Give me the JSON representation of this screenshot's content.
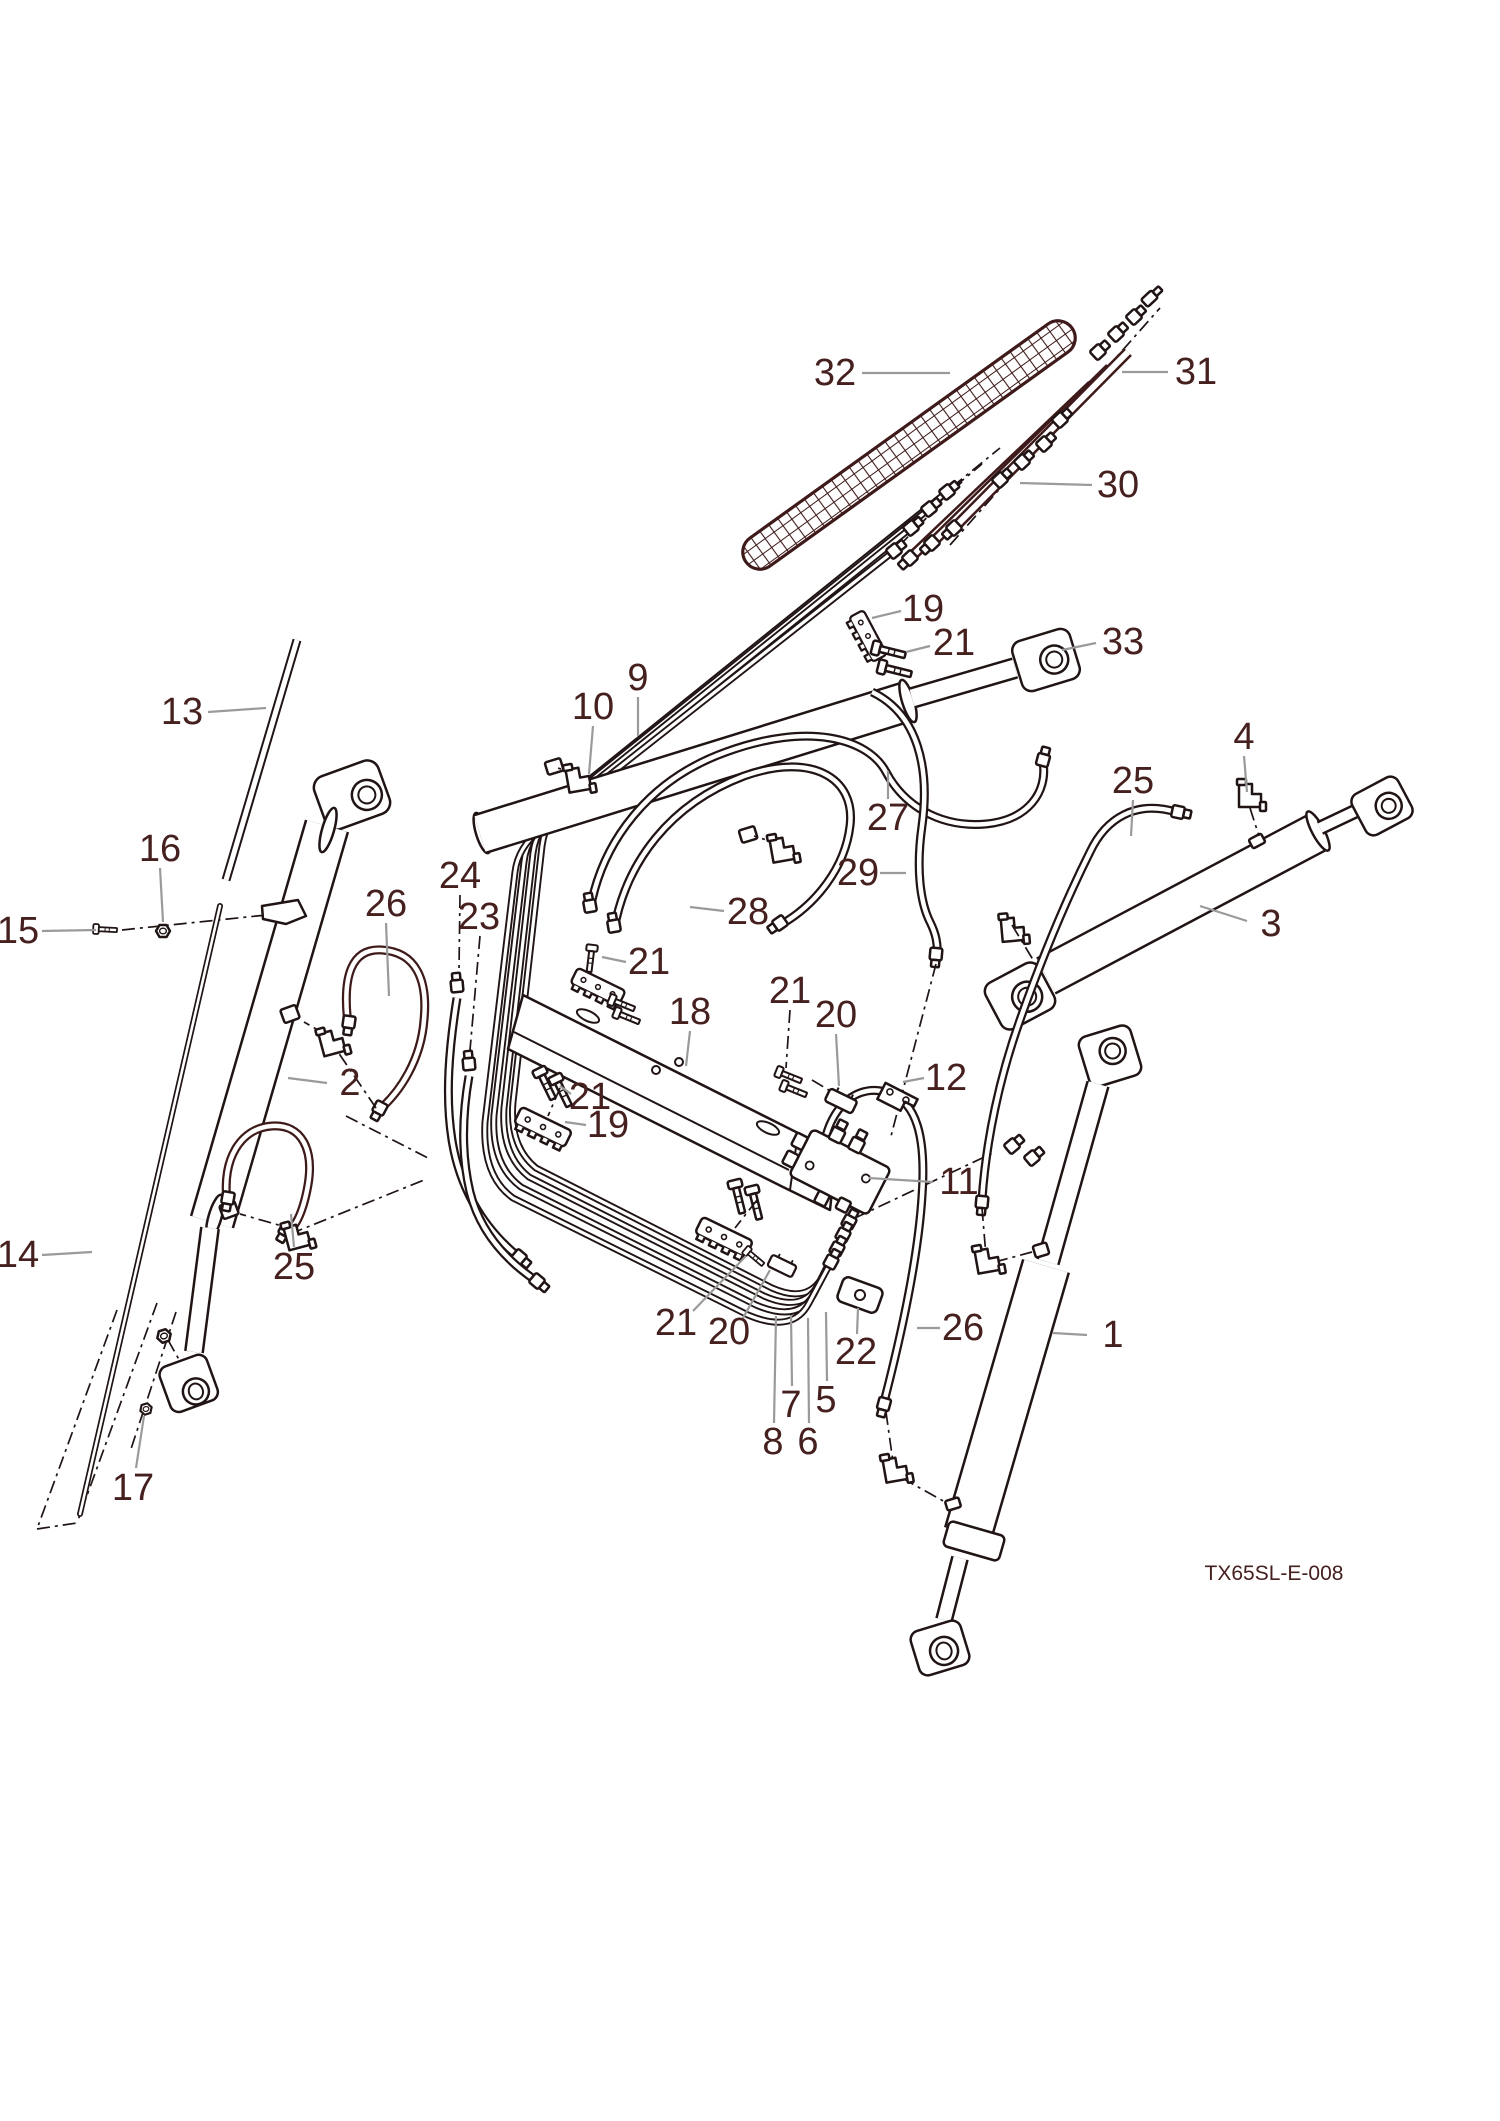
{
  "figure": {
    "code": "TX65SL-E-008"
  },
  "colors": {
    "ink": "#201414",
    "maroon": "#3e1a1a",
    "label": "#45201f",
    "leader": "#9a9a9a",
    "background": "#ffffff"
  },
  "callouts": [
    {
      "n": "32",
      "x": 835,
      "y": 373,
      "l": [
        862,
        373,
        950,
        373
      ],
      "d": false
    },
    {
      "n": "31",
      "x": 1196,
      "y": 372,
      "l": [
        1168,
        372,
        1122,
        372
      ],
      "d": false
    },
    {
      "n": "30",
      "x": 1118,
      "y": 485,
      "l": [
        1092,
        485,
        1020,
        483
      ],
      "d": false
    },
    {
      "n": "19",
      "x": 923,
      "y": 609,
      "l": [
        901,
        611,
        872,
        618
      ],
      "d": false
    },
    {
      "n": "21",
      "x": 954,
      "y": 643,
      "l": [
        930,
        646,
        906,
        652
      ],
      "d": false
    },
    {
      "n": "33",
      "x": 1123,
      "y": 642,
      "l": [
        1096,
        643,
        1062,
        650
      ],
      "d": false
    },
    {
      "n": "4",
      "x": 1244,
      "y": 737,
      "l": [
        1244,
        756,
        1247,
        792
      ],
      "d": false
    },
    {
      "n": "25",
      "x": 1133,
      "y": 781,
      "l": [
        1133,
        800,
        1131,
        836
      ],
      "d": false
    },
    {
      "n": "3",
      "x": 1271,
      "y": 924,
      "l": [
        1247,
        921,
        1200,
        906
      ],
      "d": false
    },
    {
      "n": "29",
      "x": 858,
      "y": 873,
      "l": [
        880,
        873,
        906,
        873
      ],
      "d": false
    },
    {
      "n": "27",
      "x": 888,
      "y": 818,
      "l": [
        888,
        799,
        888,
        771
      ],
      "d": false
    },
    {
      "n": "28",
      "x": 748,
      "y": 912,
      "l": [
        724,
        911,
        690,
        907
      ],
      "d": false
    },
    {
      "n": "9",
      "x": 638,
      "y": 678,
      "l": [
        638,
        697,
        638,
        736
      ],
      "d": false
    },
    {
      "n": "10",
      "x": 593,
      "y": 707,
      "l": [
        593,
        726,
        589,
        774
      ],
      "d": false
    },
    {
      "n": "24",
      "x": 460,
      "y": 876,
      "l": [
        460,
        895,
        459,
        970
      ],
      "d": true
    },
    {
      "n": "23",
      "x": 479,
      "y": 917,
      "l": [
        480,
        936,
        470,
        1050
      ],
      "d": true
    },
    {
      "n": "26",
      "x": 386,
      "y": 904,
      "l": [
        386,
        923,
        389,
        996
      ],
      "d": false
    },
    {
      "n": "2",
      "x": 350,
      "y": 1083,
      "l": [
        327,
        1083,
        288,
        1078
      ],
      "d": false
    },
    {
      "n": "25",
      "x": 294,
      "y": 1267,
      "l": [
        294,
        1247,
        291,
        1214
      ],
      "d": false
    },
    {
      "n": "13",
      "x": 182,
      "y": 712,
      "l": [
        208,
        712,
        266,
        708
      ],
      "d": false
    },
    {
      "n": "16",
      "x": 160,
      "y": 849,
      "l": [
        160,
        868,
        163,
        922
      ],
      "d": false
    },
    {
      "n": "15",
      "x": 18,
      "y": 931,
      "l": [
        42,
        931,
        96,
        930
      ],
      "d": false
    },
    {
      "n": "14",
      "x": 18,
      "y": 1255,
      "l": [
        42,
        1255,
        92,
        1252
      ],
      "d": false
    },
    {
      "n": "17",
      "x": 133,
      "y": 1488,
      "l": [
        136,
        1468,
        144,
        1416
      ],
      "d": false
    },
    {
      "n": "18",
      "x": 690,
      "y": 1012,
      "l": [
        690,
        1031,
        686,
        1066
      ],
      "d": false
    },
    {
      "n": "21",
      "x": 649,
      "y": 962,
      "l": [
        626,
        962,
        602,
        957
      ],
      "d": false
    },
    {
      "n": "21",
      "x": 790,
      "y": 991,
      "l": [
        790,
        1010,
        786,
        1068
      ],
      "d": true
    },
    {
      "n": "20",
      "x": 836,
      "y": 1015,
      "l": [
        836,
        1034,
        839,
        1086
      ],
      "d": false
    },
    {
      "n": "21",
      "x": 590,
      "y": 1097,
      "l": [
        571,
        1094,
        560,
        1086
      ],
      "d": false
    },
    {
      "n": "19",
      "x": 608,
      "y": 1125,
      "l": [
        586,
        1125,
        565,
        1122
      ],
      "d": false
    },
    {
      "n": "21",
      "x": 676,
      "y": 1323,
      "l": [
        693,
        1311,
        746,
        1256
      ],
      "d": false
    },
    {
      "n": "20",
      "x": 729,
      "y": 1332,
      "l": [
        743,
        1318,
        770,
        1270
      ],
      "d": false
    },
    {
      "n": "22",
      "x": 856,
      "y": 1352,
      "l": [
        857,
        1334,
        858,
        1308
      ],
      "d": false
    },
    {
      "n": "8",
      "x": 773,
      "y": 1442,
      "l": [
        774,
        1423,
        776,
        1316
      ],
      "d": false
    },
    {
      "n": "7",
      "x": 791,
      "y": 1405,
      "l": [
        792,
        1386,
        791,
        1315
      ],
      "d": false
    },
    {
      "n": "6",
      "x": 808,
      "y": 1442,
      "l": [
        809,
        1423,
        808,
        1318
      ],
      "d": false
    },
    {
      "n": "5",
      "x": 826,
      "y": 1400,
      "l": [
        827,
        1381,
        826,
        1312
      ],
      "d": false
    },
    {
      "n": "12",
      "x": 946,
      "y": 1078,
      "l": [
        924,
        1078,
        903,
        1082
      ],
      "d": false
    },
    {
      "n": "11",
      "x": 959,
      "y": 1182,
      "l": [
        933,
        1182,
        869,
        1178
      ],
      "d": false
    },
    {
      "n": "26",
      "x": 963,
      "y": 1328,
      "l": [
        940,
        1328,
        917,
        1328
      ],
      "d": false
    },
    {
      "n": "1",
      "x": 1113,
      "y": 1335,
      "l": [
        1087,
        1335,
        1053,
        1333
      ],
      "d": false
    }
  ]
}
